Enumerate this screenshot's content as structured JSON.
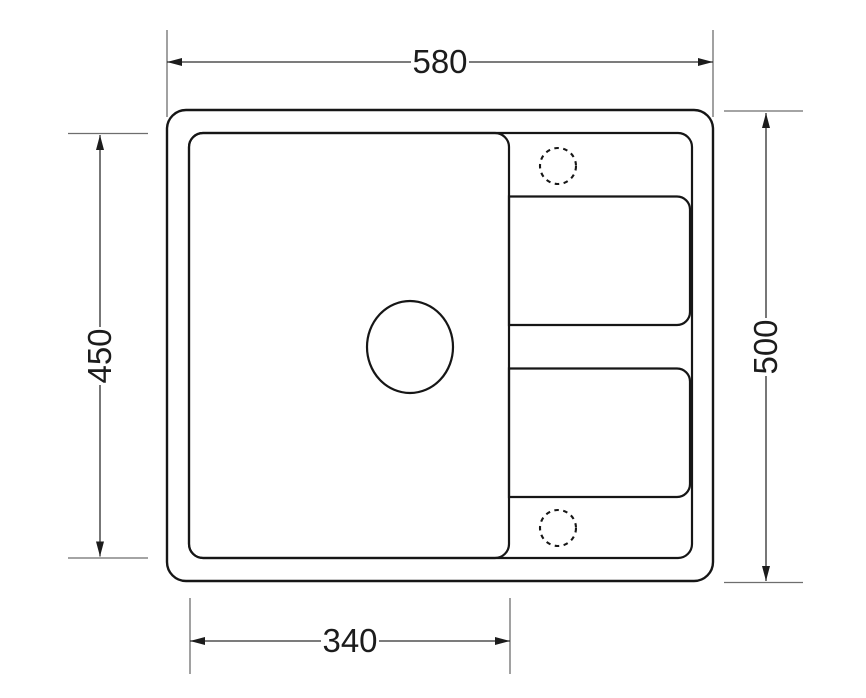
{
  "drawing": {
    "kind": "technical-dimension-drawing",
    "subject": "sink-top-view",
    "colors": {
      "background": "#ffffff",
      "part_line": "#161616",
      "dimension_line": "#2e2e2e",
      "extension_line": "#6e6e6e",
      "text": "#1c1c1c"
    },
    "dimensions": {
      "overall_width": {
        "label": "580"
      },
      "bowl_height": {
        "label": "450"
      },
      "overall_height": {
        "label": "500"
      },
      "bowl_width": {
        "label": "340"
      }
    }
  }
}
